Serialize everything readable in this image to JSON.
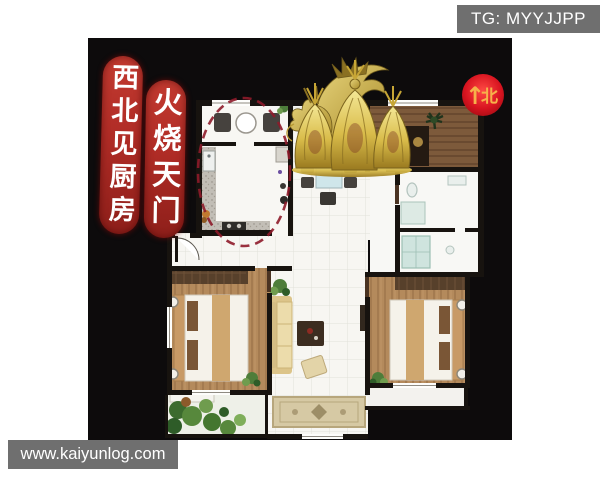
{
  "canvas": {
    "background": "#ffffff",
    "board_background": "#0d0b0c"
  },
  "watermark_top": {
    "text": "TG: MYYJJPP",
    "background": "#6f6f6f",
    "color": "#ffffff"
  },
  "watermark_bottom": {
    "text": "www.kaiyunlog.com",
    "background": "#6f6f6f",
    "color": "#ffffff"
  },
  "banner_left": {
    "text": "西北见厨房",
    "background": "#b02c26",
    "color": "#ffffff"
  },
  "banner_right": {
    "text": "火烧天门",
    "background": "#b02c26",
    "color": "#ffffff"
  },
  "compass": {
    "arrow": "↑",
    "label": "北",
    "background": "#d01420",
    "color": "#f6b14a"
  },
  "floorplan": {
    "highlight_ellipse_color": "#8e1b2a",
    "wall_color": "#17130f",
    "rooms": [
      {
        "name": "kitchen-with-breakfast-nook"
      },
      {
        "name": "dining-area"
      },
      {
        "name": "bedroom-top-right"
      },
      {
        "name": "bathroom"
      },
      {
        "name": "bedroom-left"
      },
      {
        "name": "living-room"
      },
      {
        "name": "bedroom-right"
      },
      {
        "name": "balcony-garden"
      }
    ]
  },
  "icons": {
    "statue": "golden-dragon-with-gold-ingots",
    "compass": "north-compass-badge",
    "highlight": "kitchen-highlight-dashed-ellipse"
  }
}
